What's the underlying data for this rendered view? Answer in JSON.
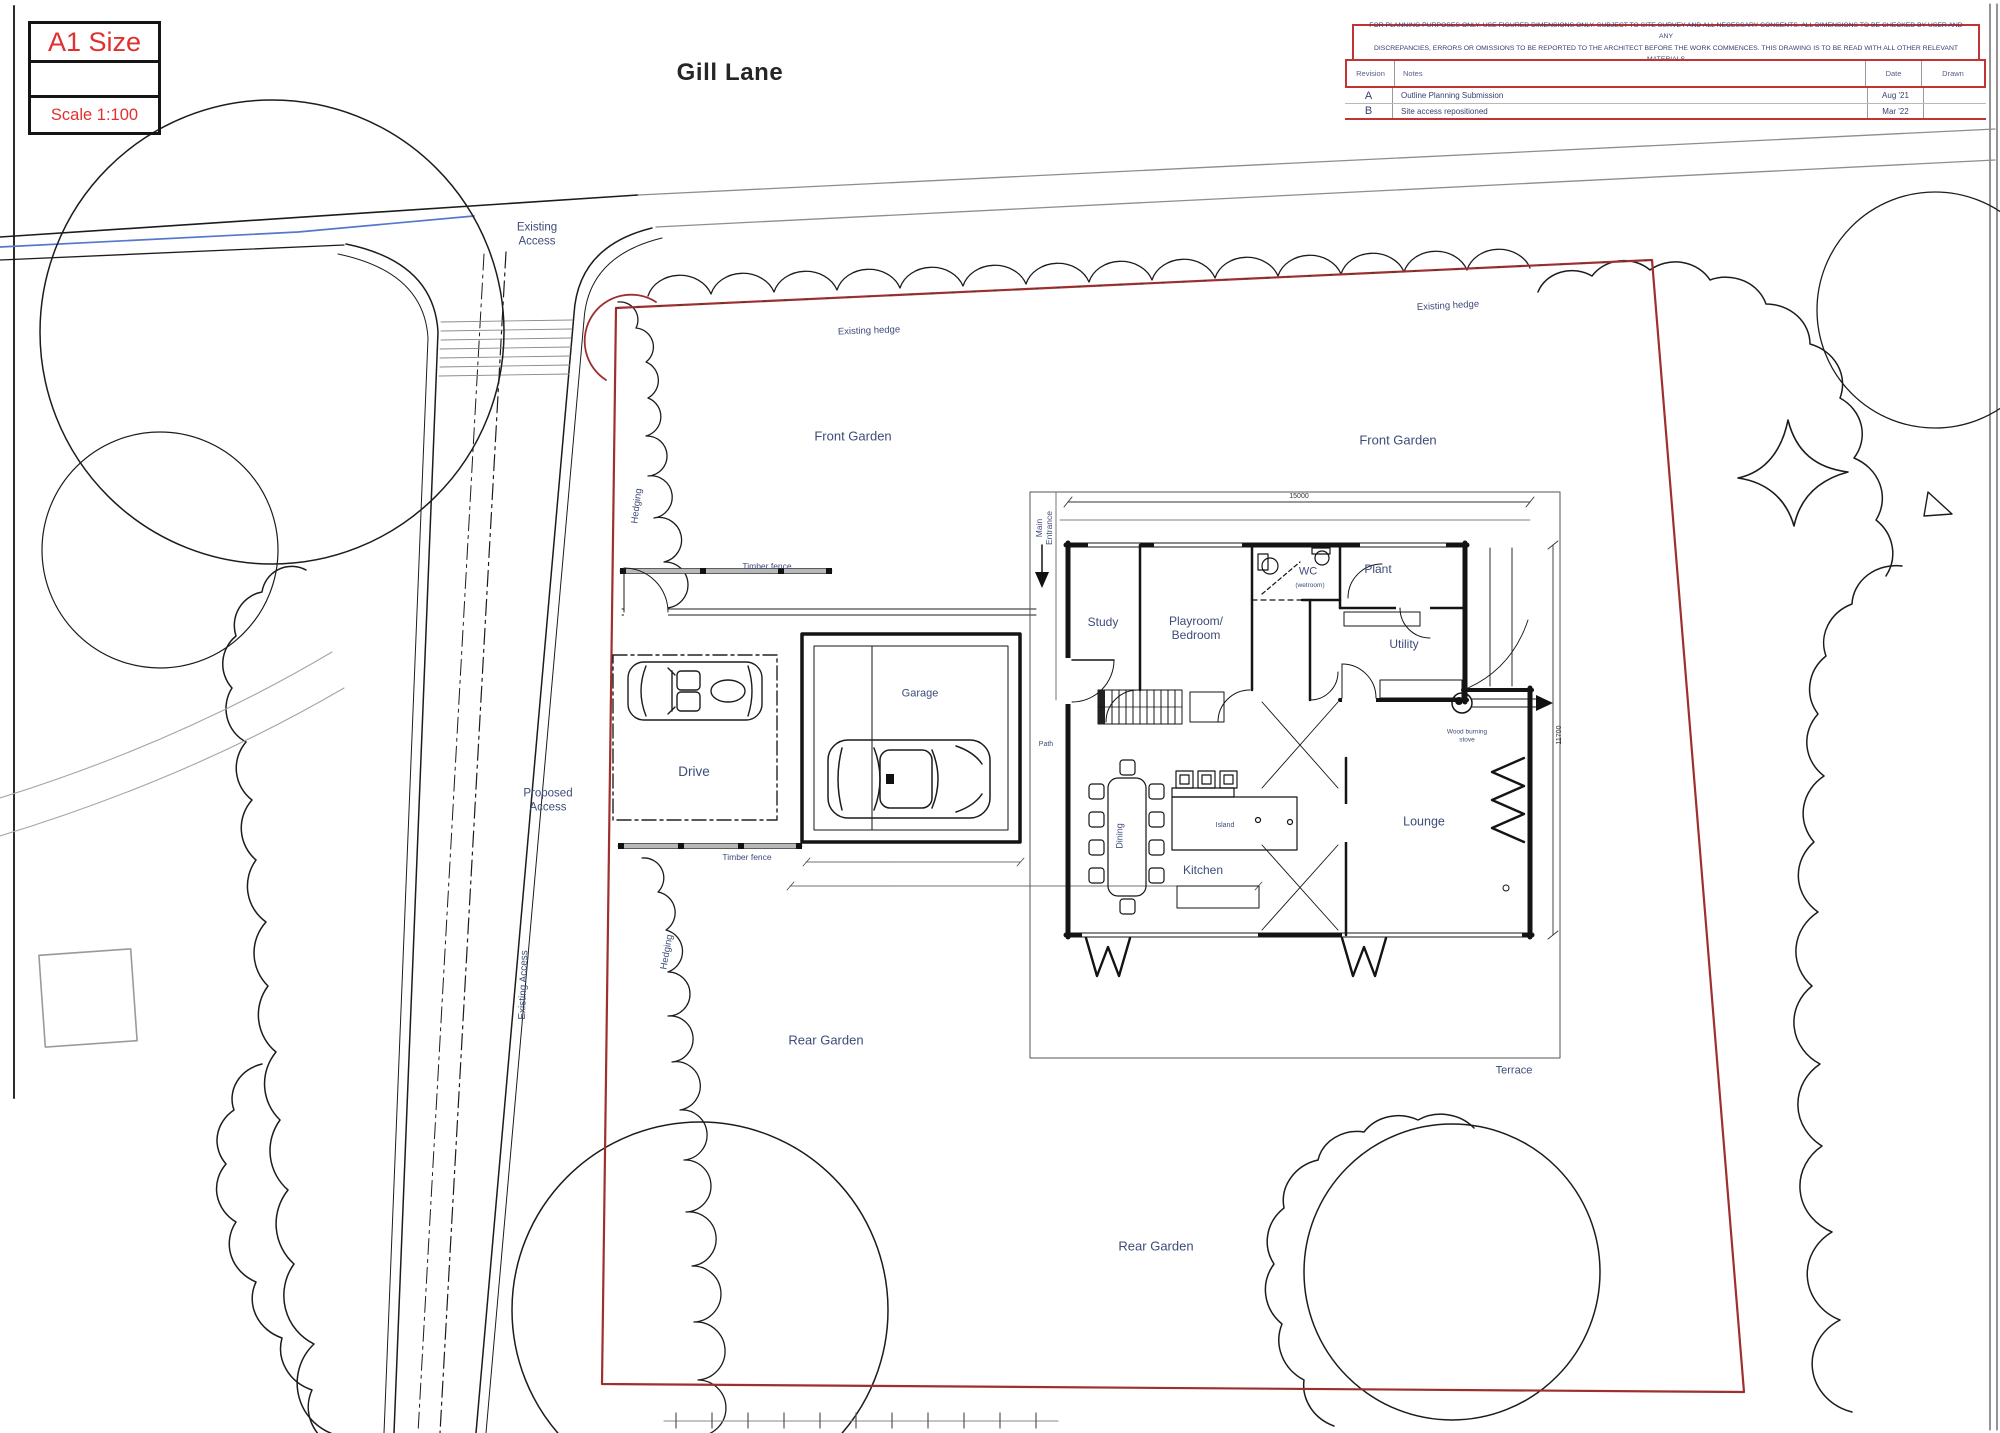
{
  "sheet": {
    "paper_size": "A1 Size",
    "scale": "Scale 1:100",
    "title": "Gill Lane"
  },
  "disclaimer": {
    "line1": "FOR PLANNING PURPOSES ONLY.  USE FIGURED DIMENSIONS ONLY. SUBJECT TO SITE SURVEY AND ALL NECESSARY CONSENTS. ALL DIMENSIONS TO BE CHECKED BY USER AND ANY",
    "line2": "DISCREPANCIES, ERRORS OR OMISSIONS TO BE REPORTED TO THE ARCHITECT BEFORE THE WORK COMMENCES.  THIS DRAWING IS TO BE READ WITH ALL OTHER RELEVANT MATERIALS"
  },
  "revision_table": {
    "headers": {
      "revision": "Revision",
      "notes": "Notes",
      "date": "Date",
      "drawn": "Drawn"
    },
    "rows": [
      {
        "revision": "A",
        "notes": "Outline Planning Submission",
        "date": "Aug '21",
        "drawn": ""
      },
      {
        "revision": "B",
        "notes": "Site access repositioned",
        "date": "Mar '22",
        "drawn": ""
      }
    ]
  },
  "site_labels": {
    "existing_access_top": "Existing Access",
    "existing_access_side": "Existing Access",
    "proposed_access": "Proposed Access",
    "front_garden_west": "Front Garden",
    "front_garden_east": "Front Garden",
    "existing_hedge_west": "Existing hedge",
    "existing_hedge_east": "Existing hedge",
    "hedging_north": "Hedging",
    "hedging_south": "Hedging",
    "timber_fence_north": "Timber fence",
    "timber_fence_south": "Timber fence",
    "rear_garden_west": "Rear Garden",
    "rear_garden_south": "Rear Garden",
    "terrace": "Terrace",
    "drive": "Drive",
    "garage": "Garage",
    "path": "Path",
    "main_entrance": "Main Entrance"
  },
  "room_labels": {
    "study": "Study",
    "playroom": "Playroom/ Bedroom",
    "wc": "WC",
    "wc_note": "(wetroom)",
    "plant": "Plant",
    "utility": "Utility",
    "wood_stove": "Wood burning stove",
    "lounge": "Lounge",
    "kitchen": "Kitchen",
    "island": "Island",
    "dining": "Dining"
  },
  "dimensions": {
    "house_width": "15000",
    "house_depth": "11700"
  }
}
